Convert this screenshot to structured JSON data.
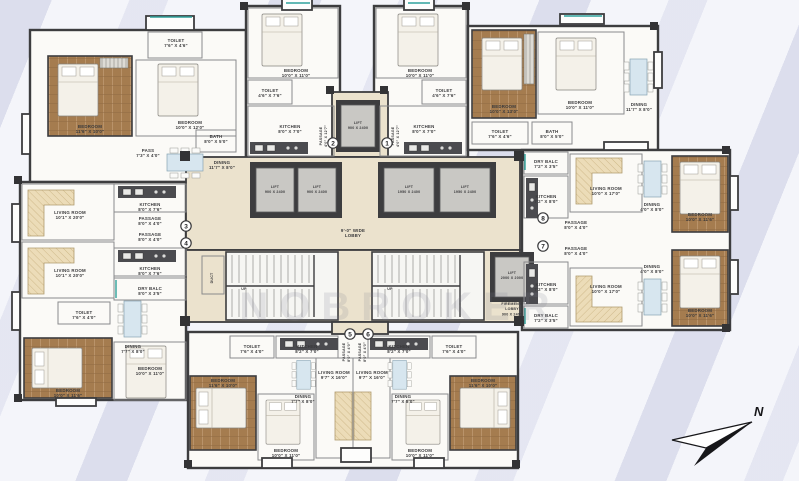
{
  "watermark": "NOBROKER",
  "compass_label": "N",
  "flats": [
    "1",
    "2",
    "3",
    "4",
    "5",
    "6",
    "7",
    "8"
  ],
  "colors": {
    "wall": "#3d3d3f",
    "lobby_floor": "#ebe2cd",
    "wood_floor": "#a57c4f",
    "sofa_beige": "#ecdcb8",
    "table_blue": "#d7e6ef",
    "accent_teal": "#2fa29b",
    "stripe_lavender": "#d2d5e9"
  },
  "rooms": {
    "lobby": [
      "9'-0\" WIDE",
      "LOBBY"
    ],
    "lift_std": [
      "LIFT",
      "900 X 2400"
    ],
    "lift_big": [
      "LIFT",
      "1950 X 2400"
    ],
    "lift_fire": [
      "LIFT",
      "2000 X 2000"
    ],
    "fire_lobby": [
      "FIREMEN'S",
      "LOBBY",
      "900 X 2400"
    ],
    "duct": [
      "DUCT"
    ],
    "up": [
      "UP"
    ],
    "tl_toilet": [
      "TOILET",
      "7'6\" X 4'6\""
    ],
    "tl_master": [
      "BEDROOM",
      "11'6\" X 10'0\""
    ],
    "tl_bed2": [
      "BEDROOM",
      "10'0\" X 12'0\""
    ],
    "tl_pass": [
      "PASS",
      "7'3\" X 4'0\""
    ],
    "tl_bath": [
      "BATH",
      "8'0\" X 5'0\""
    ],
    "tl_dining": [
      "DINING",
      "11'7\" X 8'0\""
    ],
    "lw_living": [
      "LIVING ROOM",
      "10'1\" X 20'0\""
    ],
    "lw_kitchen": [
      "KITCHEN",
      "8'0\" X 7'6\""
    ],
    "lw_pass": [
      "PASSAGE",
      "8'0\" X 4'0\""
    ],
    "lw_dry": [
      "DRY BALC",
      "8'0\" X 3'5\""
    ],
    "lw_dining": [
      "DINING",
      "7'7\" X 8'0\""
    ],
    "lw_toilet": [
      "TOILET",
      "7'6\" X 4'0\""
    ],
    "lw_master": [
      "BEDROOM",
      "10'0\" X 11'6\""
    ],
    "lw_bed2": [
      "BEDROOM",
      "10'0\" X 11'0\""
    ],
    "tc_bed": [
      "BEDROOM",
      "10'0\" X 11'0\""
    ],
    "tc_toilet": [
      "TOILET",
      "4'6\" X 7'6\""
    ],
    "tc_kitchen": [
      "KITCHEN",
      "8'0\" X 7'0\""
    ],
    "tc_pass": [
      "PASSAGE",
      "4'0\" X 12'7\""
    ],
    "tr_master": [
      "BEDROOM",
      "10'0\" X 13'0\""
    ],
    "tr_bed2": [
      "BEDROOM",
      "10'0\" X 11'0\""
    ],
    "tr_toilet": [
      "TOILET",
      "7'6\" X 4'6\""
    ],
    "tr_bath": [
      "BATH",
      "8'0\" X 5'0\""
    ],
    "tr_dining": [
      "DINING",
      "11'7\" X 8'0\""
    ],
    "rw_dry": [
      "DRY BALC",
      "7'2\" X 3'5\""
    ],
    "rw_kitchen": [
      "KITCHEN",
      "7'2\" X 8'0\""
    ],
    "rw_living": [
      "LIVING ROOM",
      "10'0\" X 17'0\""
    ],
    "rw_pass": [
      "PASSAGE",
      "8'0\" X 4'0\""
    ],
    "rw_dining": [
      "DINING",
      "4'0\" X 8'0\""
    ],
    "rw_master": [
      "BEDROOM",
      "10'0\" X 11'6\""
    ],
    "bw_toilet": [
      "TOILET",
      "7'6\" X 4'0\""
    ],
    "bw_kitchen": [
      "KITCHEN",
      "8'2\" X 7'0\""
    ],
    "bw_pass": [
      "PASSAGE",
      "8'0\" X 4'0\""
    ],
    "bw_living": [
      "LIVING ROOM",
      "9'7\" X 16'0\""
    ],
    "bw_dining": [
      "DINING",
      "7'7\" X 8'0\""
    ],
    "bw_bed": [
      "BEDROOM",
      "10'0\" X 11'0\""
    ],
    "bw_master": [
      "BEDROOM",
      "11'6\" X 10'0\""
    ]
  }
}
